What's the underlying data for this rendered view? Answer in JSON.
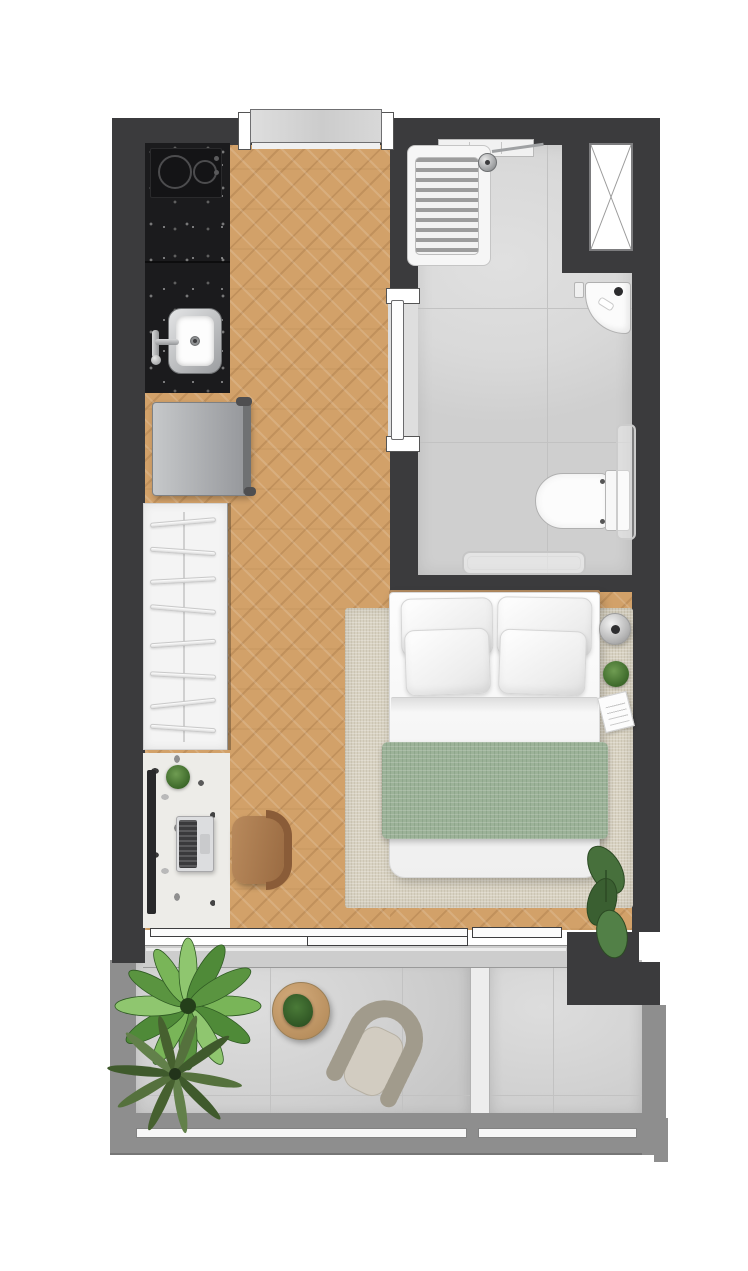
{
  "scene": {
    "title": "Studio apartment floor plan, top-down render",
    "view": "top-down"
  },
  "palette": {
    "wall": "#3b3b3d",
    "wood": "#d2a169",
    "tile": "#d9d9d9",
    "concrete": "#d2d2d2",
    "balcony_wall": "#8e8e8e",
    "rug": "#d8d2c2",
    "blanket": "#9cb298",
    "granite": "#1b1b1d",
    "terrazzo": "#edece8",
    "leather": "#a97a50",
    "green": "#55893c",
    "white_fixture": "#fbfbfb"
  },
  "rooms": {
    "kitchen": {
      "label": "Kitchen"
    },
    "main": {
      "label": "Living / sleeping area"
    },
    "bathroom": {
      "label": "Bathroom"
    },
    "balcony": {
      "label": "Balcony"
    },
    "neighbor_balcony": {
      "label": "Adjacent balcony section"
    }
  },
  "objects": {
    "entrance_door": "Entrance door",
    "cooktop": "2-burner cooktop",
    "counter": "Granite kitchen counter",
    "kitchen_sink": "Kitchen sink with faucet",
    "fridge": "Refrigerator",
    "wardrobe": "Open wardrobe with hangers",
    "desk": "Terrazzo desk",
    "tv": "TV / monitor",
    "laptop": "Laptop",
    "desk_chair": "Desk chair",
    "desk_plant": "Potted plant",
    "rug": "Area rug",
    "bed": "Double bed",
    "pillow": "Pillow",
    "blanket": "Green throw blanket",
    "lamp": "Bedside sphere lamp",
    "night_plant": "Potted plant",
    "book": "Book",
    "monstera": "Monstera plant",
    "shower": "Walk-in shower with drain grate",
    "shower_head": "Shower head",
    "niche": "Shower niche shelf",
    "bath_sink": "Corner washbasin",
    "toilet": "Toilet",
    "towel_rail": "Towel rail",
    "bath_mat": "Bath mat",
    "bath_door": "Sliding bathroom door",
    "shaft": "Ventilation shaft",
    "balcony_door": "Sliding balcony door",
    "balcony_table": "Round side table",
    "table_plant": "Potted plant",
    "wicker_chair": "Wicker armchair",
    "calathea": "Calathea plant",
    "palm": "Palm plant",
    "railing": "Glass railing",
    "divider": "Balcony privacy divider"
  }
}
